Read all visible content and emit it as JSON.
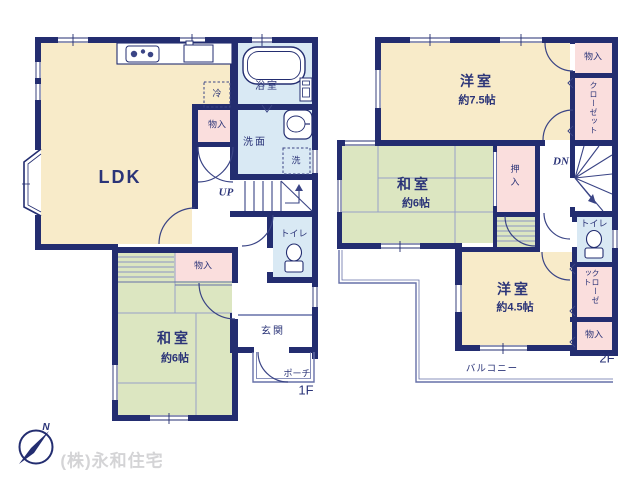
{
  "colors": {
    "wall": "#232d70",
    "room_cream": "#f8ebc9",
    "room_green": "#dce6c1",
    "room_blue": "#d9e9f4",
    "room_pink": "#fadedd",
    "thin_line": "#6670a8",
    "text": "#2b3478",
    "watermark": "#d4d4d6"
  },
  "f1": {
    "floor": "1F",
    "ldk": "LDK",
    "washitsu": "和室",
    "washitsu_size": "約6帖",
    "bath": "浴室",
    "wash": "洗面",
    "toilet": "トイレ",
    "entrance": "玄関",
    "porch": "ポーチ",
    "storage_hall": "物入",
    "storage_washitsu": "物入",
    "fridge": "冷",
    "laundry": "洗",
    "up": "UP"
  },
  "f2": {
    "floor": "2F",
    "western1": "洋室",
    "western1_size": "約7.5帖",
    "washitsu": "和室",
    "washitsu_size": "約6帖",
    "western2": "洋室",
    "western2_size": "約4.5帖",
    "storage_top": "物入",
    "closet_top": "クローゼット",
    "oshiire": "押入",
    "dn": "DN",
    "toilet": "トイレ",
    "closet_right": "クローゼット",
    "storage_bottom": "物入",
    "balcony": "バルコニー"
  },
  "compass_n": "N",
  "watermark": "(株)永和住宅"
}
